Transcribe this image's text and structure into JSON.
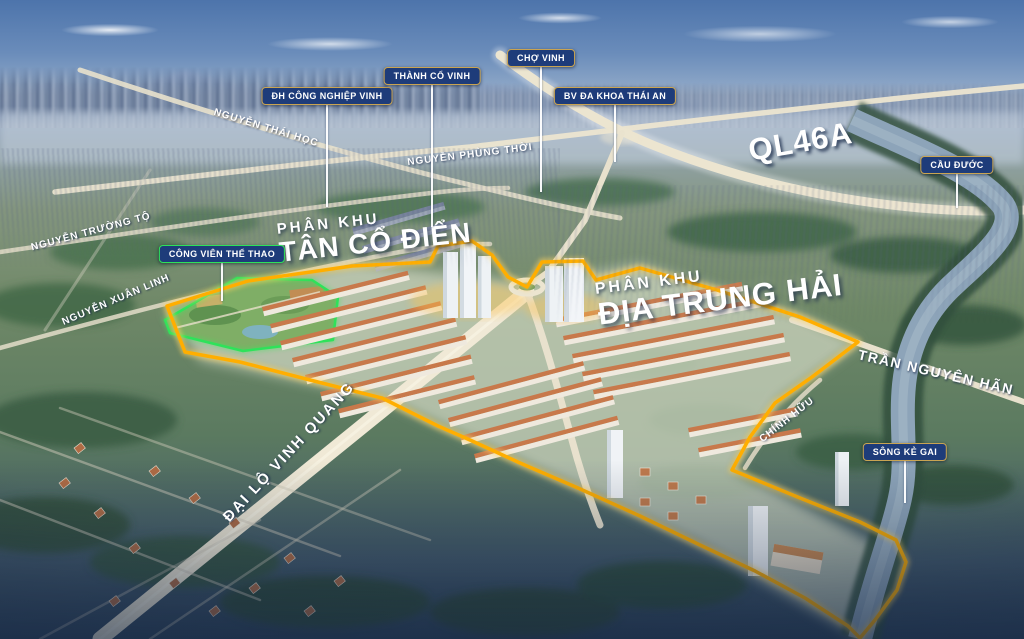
{
  "canvas": {
    "width": 1024,
    "height": 639
  },
  "colors": {
    "label_background": "#1e3c7a",
    "label_border_gold": "#c9a452",
    "park_outline_green": "#2ee25a",
    "boundary_orange": "#ffae00",
    "title_text": "#ffffff",
    "sky_blue": "#4d74ab",
    "road_cream": "#ece5d0",
    "river_water": "#8da4b9"
  },
  "landmarks": [
    {
      "id": "dh-cong-nghiep-vinh",
      "text": "ĐH CÔNG NGHIỆP VINH",
      "type": "blue"
    },
    {
      "id": "thanh-co-vinh",
      "text": "THÀNH CỔ VINH",
      "type": "blue"
    },
    {
      "id": "cho-vinh",
      "text": "CHỢ VINH",
      "type": "blue"
    },
    {
      "id": "bv-da-khoa-thai-an",
      "text": "BV ĐA KHOA THÁI AN",
      "type": "blue"
    },
    {
      "id": "cau-duoc",
      "text": "CẦU ĐƯỚC",
      "type": "blue"
    },
    {
      "id": "song-ke-gai",
      "text": "SÔNG KẺ GAI",
      "type": "blue"
    },
    {
      "id": "cong-vien-the-thao",
      "text": "CÔNG VIÊN THỂ THAO",
      "type": "green"
    }
  ],
  "roads": [
    {
      "id": "nguyen-thai-hoc",
      "text": "NGUYỄN THÁI HỌC"
    },
    {
      "id": "nguyen-phung-thoi",
      "text": "NGUYỄN PHÙNG THỜI"
    },
    {
      "id": "nguyen-truong-to",
      "text": "NGUYỄN TRƯỜNG TỘ"
    },
    {
      "id": "nguyen-xuan-linh",
      "text": "NGUYỄN XUÂN LINH"
    },
    {
      "id": "dai-lo-vinh-quang",
      "text": "ĐẠI LỘ VINH QUANG"
    },
    {
      "id": "tran-nguyen-han",
      "text": "TRẦN NGUYÊN HÃN"
    },
    {
      "id": "chinh-huu",
      "text": "CHÍNH HỮU"
    },
    {
      "id": "ql46a",
      "text": "QL46A"
    }
  ],
  "zones": [
    {
      "id": "tan-co-dien",
      "subtitle": "PHÂN KHU",
      "title": "TÂN CỔ ĐIỂN"
    },
    {
      "id": "dia-trung-hai",
      "subtitle": "PHÂN KHU",
      "title": "ĐỊA TRUNG HẢI"
    }
  ]
}
